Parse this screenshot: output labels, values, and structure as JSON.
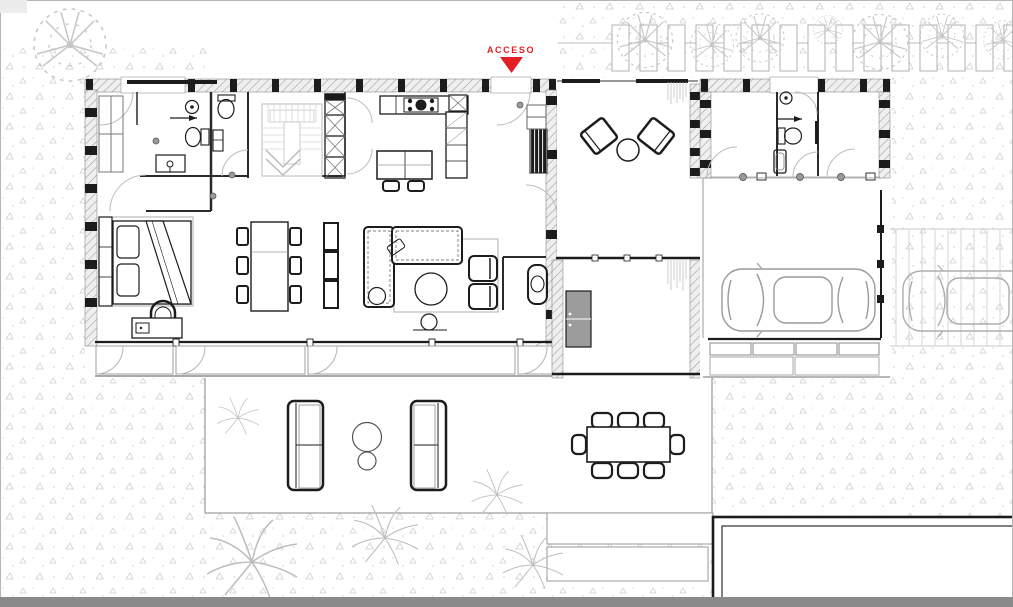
{
  "plan": {
    "access_label": "ACCESO",
    "marker": "triangle-down",
    "colors": {
      "accent": "#E31E25",
      "ink": "#1c1c1c",
      "wall_gray": "#9b9b9b",
      "glass_gray": "#a8a8a8",
      "vegetation_gray": "#c5c5c5",
      "cabinet_gray": "#9c9c9c",
      "frame_bar_gray": "#8a8a8a",
      "paper_white": "#ffffff"
    },
    "depicted_elements": {
      "rooms": [
        "dressing-room",
        "bathroom",
        "guest-toilet",
        "staircase",
        "kitchen",
        "bedroom",
        "dining-area",
        "living-room",
        "entrance-hall",
        "patio-courtyard",
        "corridor",
        "storage-room",
        "guest-bathroom",
        "guest-room",
        "garage"
      ],
      "exterior": [
        "garden",
        "paver-path",
        "terrace",
        "outdoor-lounge",
        "outdoor-dining",
        "garden-steps",
        "pool",
        "driveway",
        "parked-car",
        "trees"
      ]
    }
  }
}
